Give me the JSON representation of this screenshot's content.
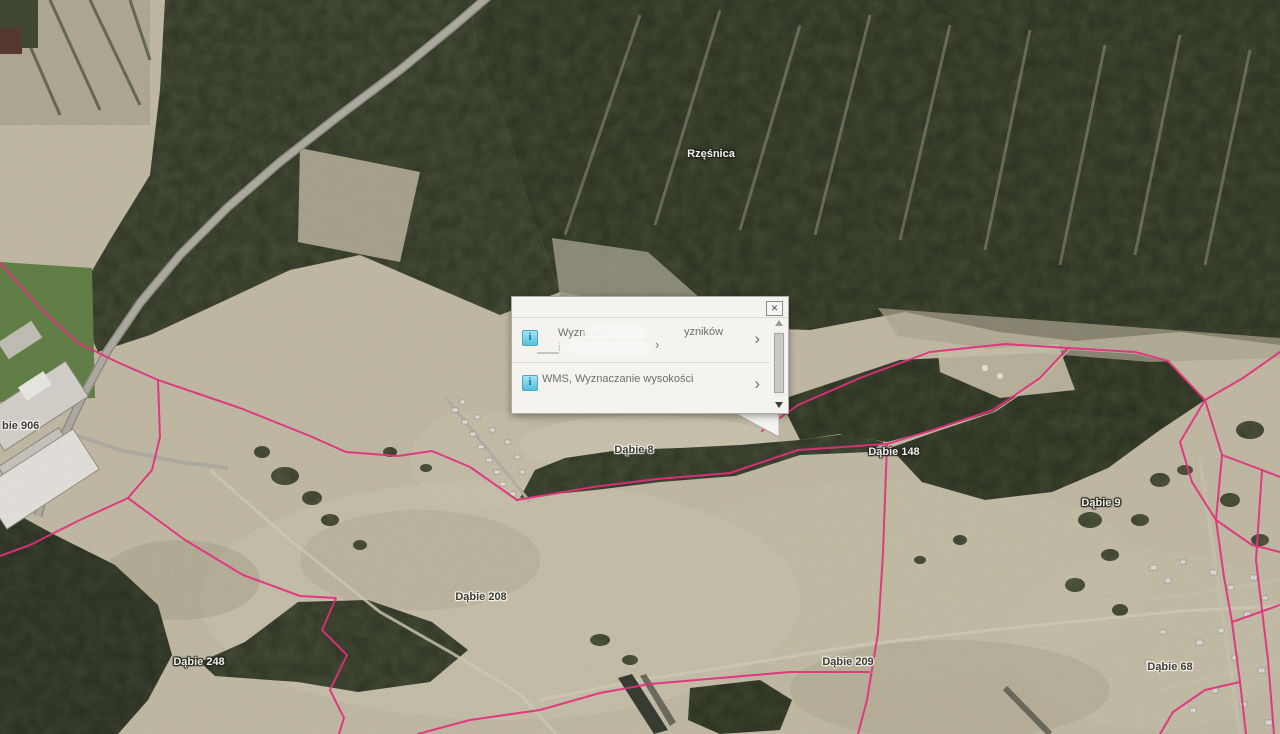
{
  "map": {
    "parcel_line_color": "#e2307c",
    "place_labels": [
      {
        "text": "Rzęśnica",
        "x": 711,
        "y": 148,
        "tone": "light"
      },
      {
        "text": "Dąbie 8",
        "x": 634,
        "y": 444,
        "tone": "dark"
      },
      {
        "text": "Dąbie 148",
        "x": 894,
        "y": 446,
        "tone": "light"
      },
      {
        "text": "Dąbie 9",
        "x": 1101,
        "y": 497,
        "tone": "light"
      },
      {
        "text": "Dąbie 208",
        "x": 481,
        "y": 591,
        "tone": "dark"
      },
      {
        "text": "Dąbie 248",
        "x": 199,
        "y": 656,
        "tone": "light"
      },
      {
        "text": "Dąbie 209",
        "x": 848,
        "y": 656,
        "tone": "dark"
      },
      {
        "text": "Dąbie 68",
        "x": 1170,
        "y": 661,
        "tone": "dark"
      },
      {
        "text": "bie 906",
        "x": 2,
        "y": 420,
        "tone": "dark",
        "align": "left"
      }
    ],
    "parcel_lines": [
      [
        [
          0,
          263
        ],
        [
          45,
          313
        ],
        [
          78,
          343
        ],
        [
          117,
          362
        ],
        [
          158,
          380
        ],
        [
          240,
          408
        ],
        [
          310,
          436
        ],
        [
          346,
          452
        ],
        [
          398,
          456
        ],
        [
          432,
          451
        ],
        [
          470,
          467
        ],
        [
          517,
          500
        ]
      ],
      [
        [
          517,
          500
        ],
        [
          593,
          487
        ],
        [
          657,
          479
        ],
        [
          730,
          473
        ],
        [
          798,
          450
        ],
        [
          887,
          444
        ]
      ],
      [
        [
          887,
          444
        ],
        [
          883,
          553
        ],
        [
          878,
          633
        ],
        [
          867,
          700
        ],
        [
          858,
          734
        ]
      ],
      [
        [
          887,
          444
        ],
        [
          933,
          430
        ],
        [
          993,
          410
        ],
        [
          1040,
          378
        ],
        [
          1068,
          348
        ]
      ],
      [
        [
          762,
          431
        ],
        [
          798,
          405
        ],
        [
          860,
          378
        ],
        [
          930,
          352
        ],
        [
          1005,
          344
        ],
        [
          1068,
          348
        ]
      ],
      [
        [
          1068,
          348
        ],
        [
          1135,
          352
        ],
        [
          1168,
          361
        ],
        [
          1205,
          400
        ],
        [
          1222,
          455
        ],
        [
          1216,
          520
        ],
        [
          1224,
          577
        ],
        [
          1232,
          622
        ],
        [
          1240,
          682
        ],
        [
          1246,
          734
        ]
      ],
      [
        [
          1280,
          352
        ],
        [
          1243,
          378
        ],
        [
          1205,
          400
        ]
      ],
      [
        [
          1222,
          455
        ],
        [
          1262,
          470
        ],
        [
          1280,
          477
        ]
      ],
      [
        [
          1216,
          520
        ],
        [
          1252,
          545
        ],
        [
          1280,
          552
        ]
      ],
      [
        [
          1232,
          622
        ],
        [
          1266,
          610
        ],
        [
          1280,
          605
        ]
      ],
      [
        [
          1262,
          470
        ],
        [
          1256,
          560
        ],
        [
          1268,
          660
        ],
        [
          1274,
          734
        ]
      ],
      [
        [
          158,
          380
        ],
        [
          160,
          437
        ],
        [
          152,
          470
        ],
        [
          128,
          498
        ]
      ],
      [
        [
          128,
          498
        ],
        [
          80,
          520
        ],
        [
          30,
          545
        ],
        [
          0,
          556
        ]
      ],
      [
        [
          128,
          498
        ],
        [
          185,
          540
        ],
        [
          243,
          575
        ],
        [
          300,
          596
        ],
        [
          336,
          598
        ],
        [
          322,
          630
        ],
        [
          347,
          655
        ],
        [
          330,
          690
        ],
        [
          344,
          718
        ],
        [
          339,
          734
        ]
      ],
      [
        [
          418,
          734
        ],
        [
          470,
          720
        ],
        [
          540,
          710
        ],
        [
          600,
          693
        ],
        [
          650,
          684
        ],
        [
          720,
          678
        ],
        [
          790,
          672
        ],
        [
          869,
          672
        ]
      ],
      [
        [
          1205,
          400
        ],
        [
          1180,
          442
        ],
        [
          1192,
          482
        ],
        [
          1216,
          520
        ]
      ],
      [
        [
          1240,
          682
        ],
        [
          1205,
          690
        ],
        [
          1173,
          712
        ],
        [
          1160,
          734
        ]
      ]
    ]
  },
  "popup": {
    "items": [
      {
        "t1": "Wyznacza",
        "t2": "ryb",
        "t3": "yzników",
        "l2_hint": "i"
      },
      {
        "title": "WMS, Wyznaczanie wysokości"
      }
    ]
  },
  "icons": {
    "info": "i",
    "close": "✕",
    "chevron": "›"
  },
  "colors": {
    "parcel_line": "#e2307c",
    "popup_bg": "#f4f3f0",
    "info_icon": "#55c0dc"
  }
}
